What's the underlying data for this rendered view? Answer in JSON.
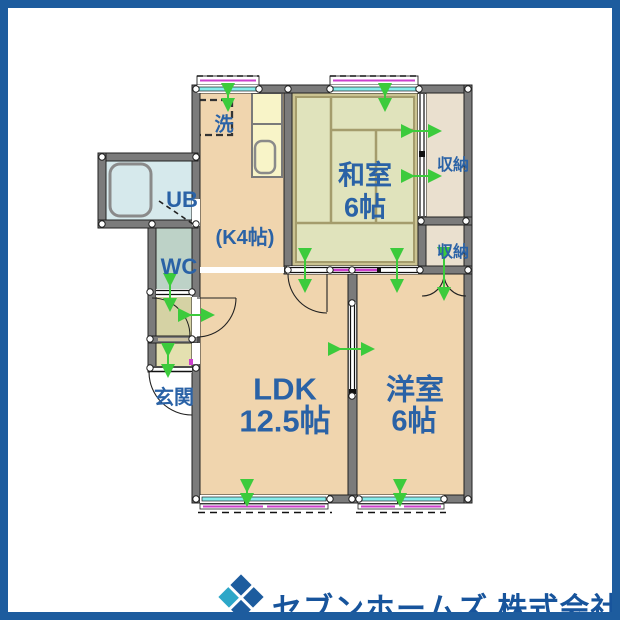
{
  "colors": {
    "frame_blue": "#1d5c9e",
    "logo_cyan": "#2da7c8",
    "label_blue": "#2a62a6",
    "floor_tan": "#f0d5ae",
    "tatami_green": "#e0e3bc",
    "tatami_border": "#cbc391",
    "closet_beige": "#eae0cf",
    "bath_blue": "#d6e9ec",
    "wc_green": "#bdd2c7",
    "hall_olive": "#d5d2a4",
    "genkan_olive": "#e4e0b0",
    "counter_yellow": "#f8f4c8",
    "window_cyan": "#86ecec",
    "shutter_magenta": "#cc3fcc",
    "opening_green": "#3ccb3c",
    "wall_gray": "#7b7b7b"
  },
  "floorplan": {
    "rooms": {
      "ldk": {
        "name": "LDK",
        "size": "12.5帖"
      },
      "washitsu": {
        "name": "和室",
        "size": "6帖"
      },
      "yoshitsu": {
        "name": "洋室",
        "size": "6帖"
      },
      "kitchen": {
        "label": "(K4帖)"
      },
      "ub": {
        "label": "UB"
      },
      "wc": {
        "label": "WC"
      },
      "genkan": {
        "label": "玄関"
      },
      "closet_upper": {
        "label": "収納"
      },
      "closet_lower": {
        "label": "収納"
      },
      "laundry": {
        "label": "洗"
      }
    }
  },
  "footer": {
    "company": "セブンホームズ 株式会社"
  }
}
